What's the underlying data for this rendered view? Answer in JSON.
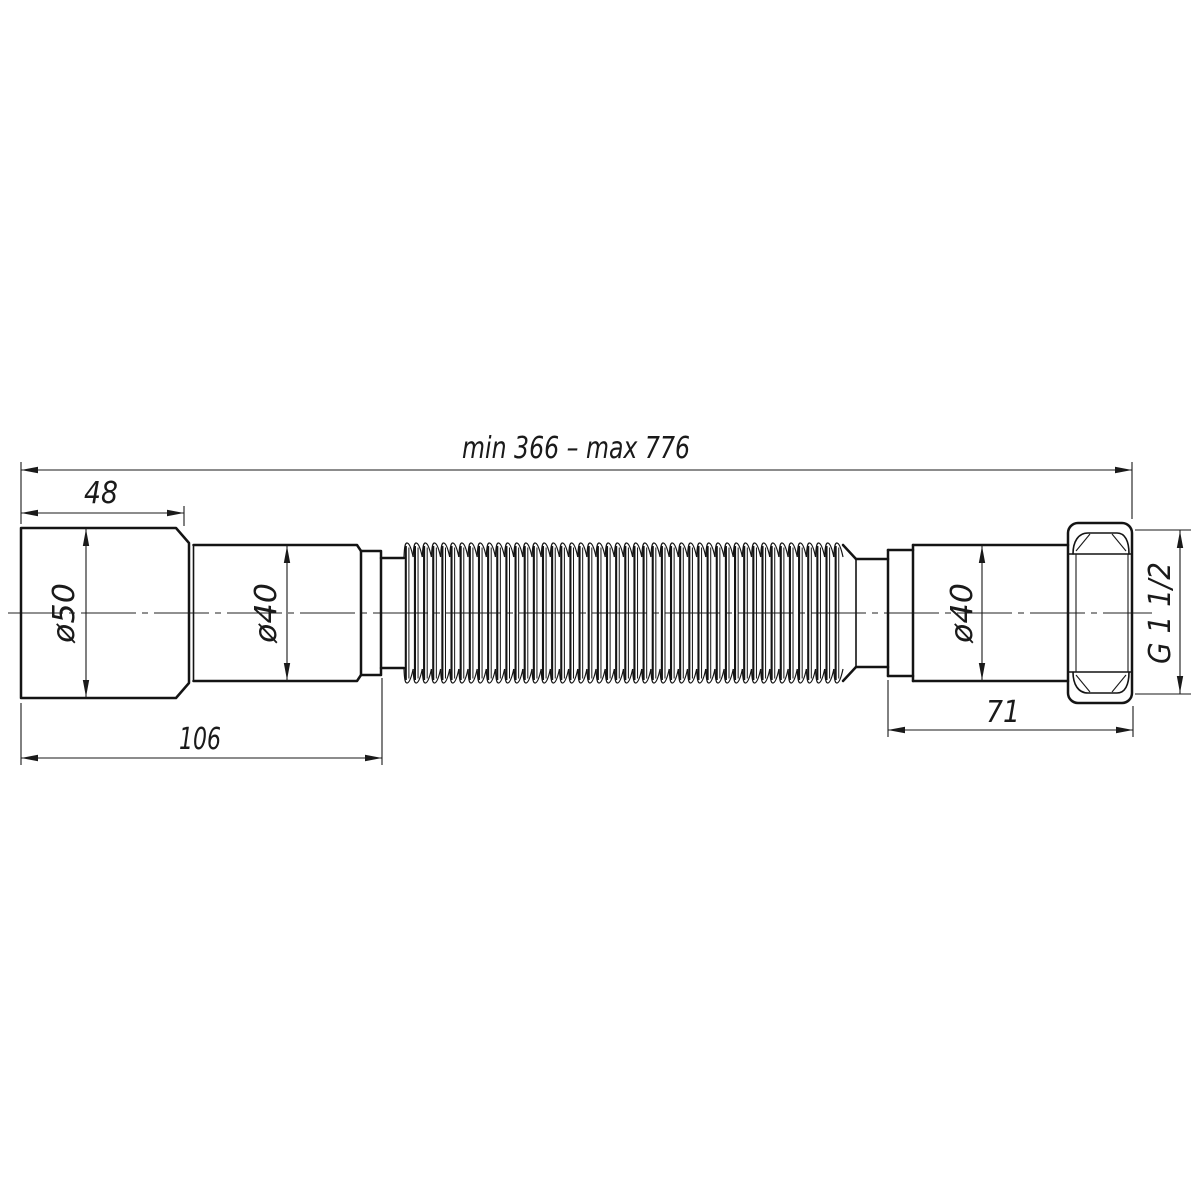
{
  "drawing": {
    "type": "technical-drawing",
    "subject": "flexible corrugated drain pipe with coupling nut",
    "background_color": "#ffffff",
    "line_color": "#141414",
    "dimensions": {
      "overall_length": "min 366 – max 776",
      "inlet_length": "48",
      "inlet_diameter": "ø50",
      "inlet_tube_diameter": "ø40",
      "inlet_assembly_length": "106",
      "outlet_tube_diameter": "ø40",
      "outlet_assembly_length": "71",
      "nut_thread": "G 1 1/2"
    }
  }
}
